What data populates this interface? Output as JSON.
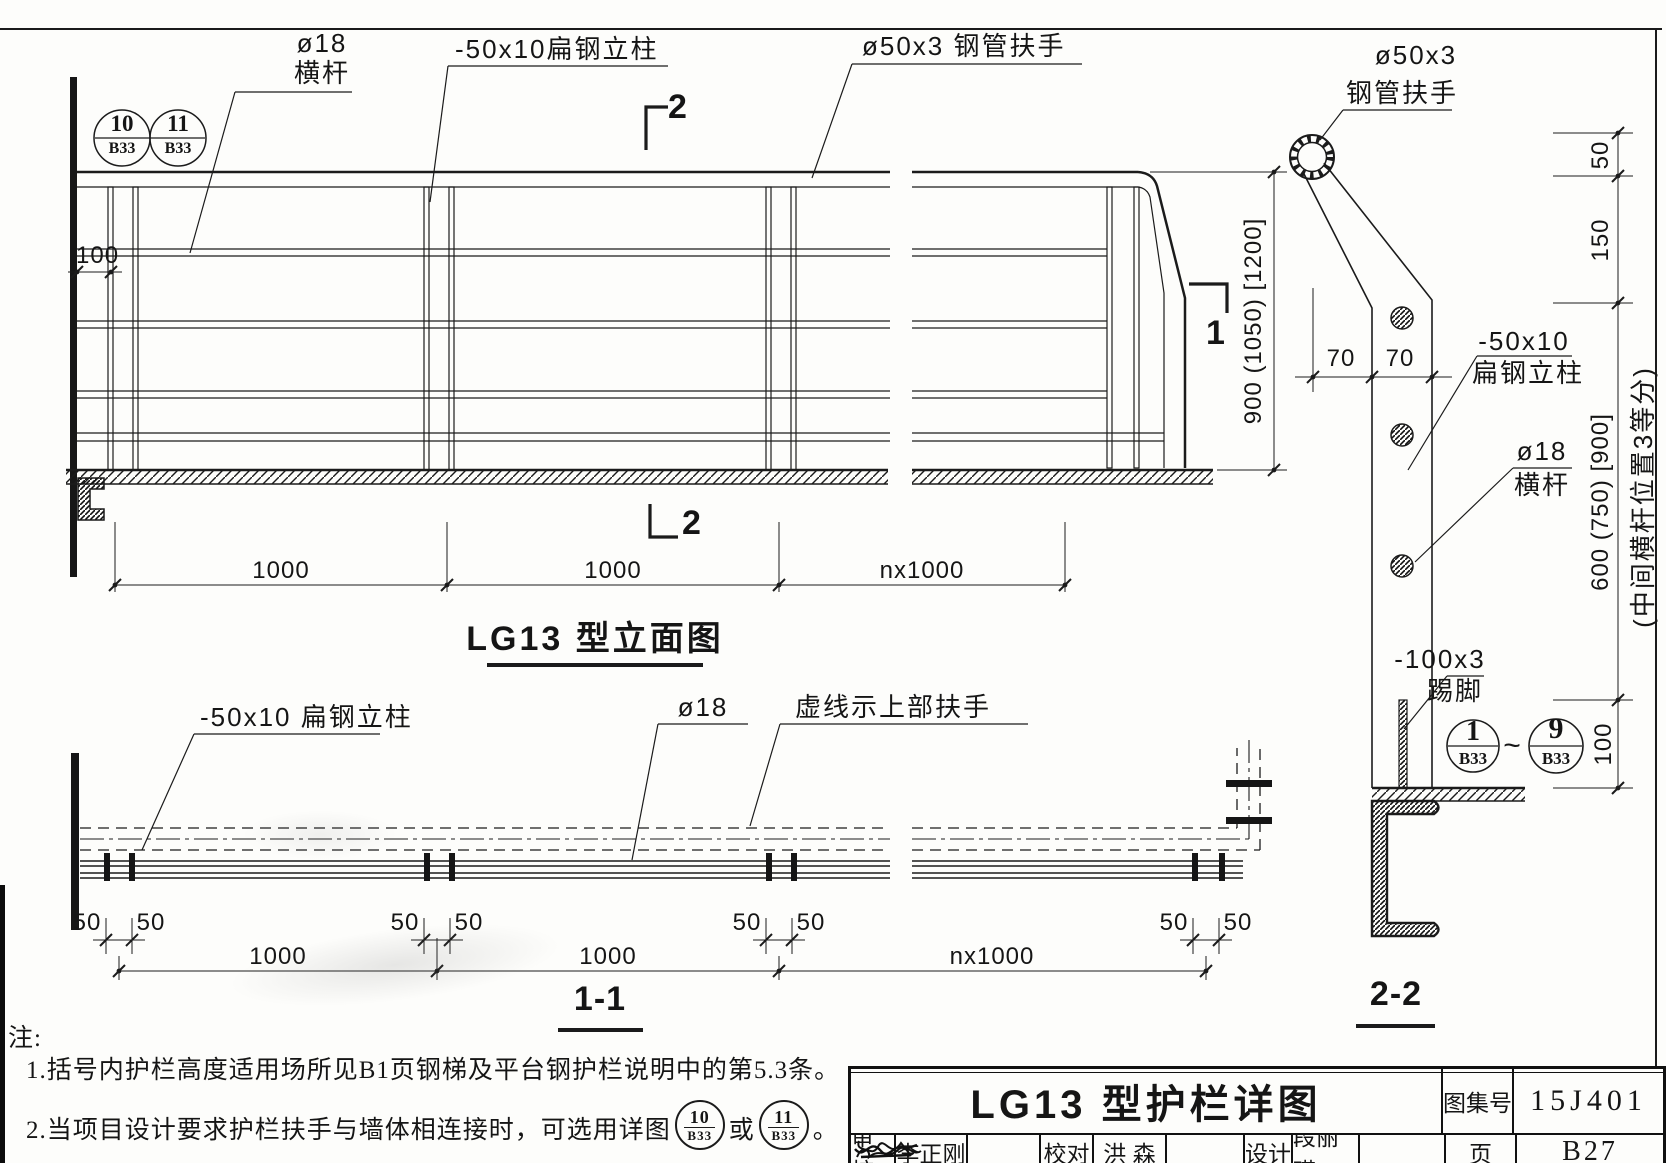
{
  "elevation": {
    "title": "LG13 型立面图",
    "label_crossbar_size": "ø18",
    "label_crossbar_name": "横杆",
    "label_post": "-50x10扁钢立柱",
    "label_handrail": "ø50x3 钢管扶手",
    "ref1_num": "10",
    "ref1_sheet": "B33",
    "ref2_num": "11",
    "ref2_sheet": "B33",
    "dim_wall_gap": "100",
    "dim_height": "900 (1050) [1200]",
    "dim_span1": "1000",
    "dim_span2": "1000",
    "dim_span3": "nx1000",
    "mark_top": "2",
    "mark_bottom": "2",
    "mark_side": "1"
  },
  "plan": {
    "title": "1-1",
    "label_post": "-50x10 扁钢立柱",
    "label_crossbar": "ø18",
    "label_dashed": "虚线示上部扶手",
    "dim_offset": "50",
    "dim_span1": "1000",
    "dim_span2": "1000",
    "dim_span3": "nx1000"
  },
  "section": {
    "title": "2-2",
    "label_handrail_size": "ø50x3",
    "label_handrail_name": "钢管扶手",
    "label_post_size": "-50x10",
    "label_post_name": "扁钢立柱",
    "label_crossbar_size": "ø18",
    "label_crossbar_name": "横杆",
    "label_toe_size": "-100x3",
    "label_toe_name": "踢脚",
    "dim_70a": "70",
    "dim_70b": "70",
    "dim_top": "50",
    "dim_second": "150",
    "dim_mid": "600 (750) [900]",
    "dim_mid_note": "(中间横杆位置3等分)",
    "dim_toe": "100",
    "ref_from_num": "1",
    "ref_from_sheet": "B33",
    "ref_to_num": "9",
    "ref_to_sheet": "B33",
    "tilde": "~"
  },
  "notes": {
    "heading": "注:",
    "line1": "1.括号内护栏高度适用场所见B1页钢梯及平台钢护栏说明中的第5.3条。",
    "line2_text": "2.当项目设计要求护栏扶手与墙体相连接时，可选用详图",
    "line2_or": "或",
    "line2_end": "。",
    "ref_a_num": "10",
    "ref_a_sheet": "B33",
    "ref_b_num": "11",
    "ref_b_sheet": "B33"
  },
  "titleblock": {
    "drawing_title": "LG13 型护栏详图",
    "atlas_label": "图集号",
    "atlas_no": "15J401",
    "page_label": "页",
    "page_no": "B27",
    "review_label": "审核",
    "reviewer": "李正刚",
    "proof_label": "校对",
    "proofer": "洪  森",
    "design_label": "设计",
    "designer": "段丽瑛"
  }
}
